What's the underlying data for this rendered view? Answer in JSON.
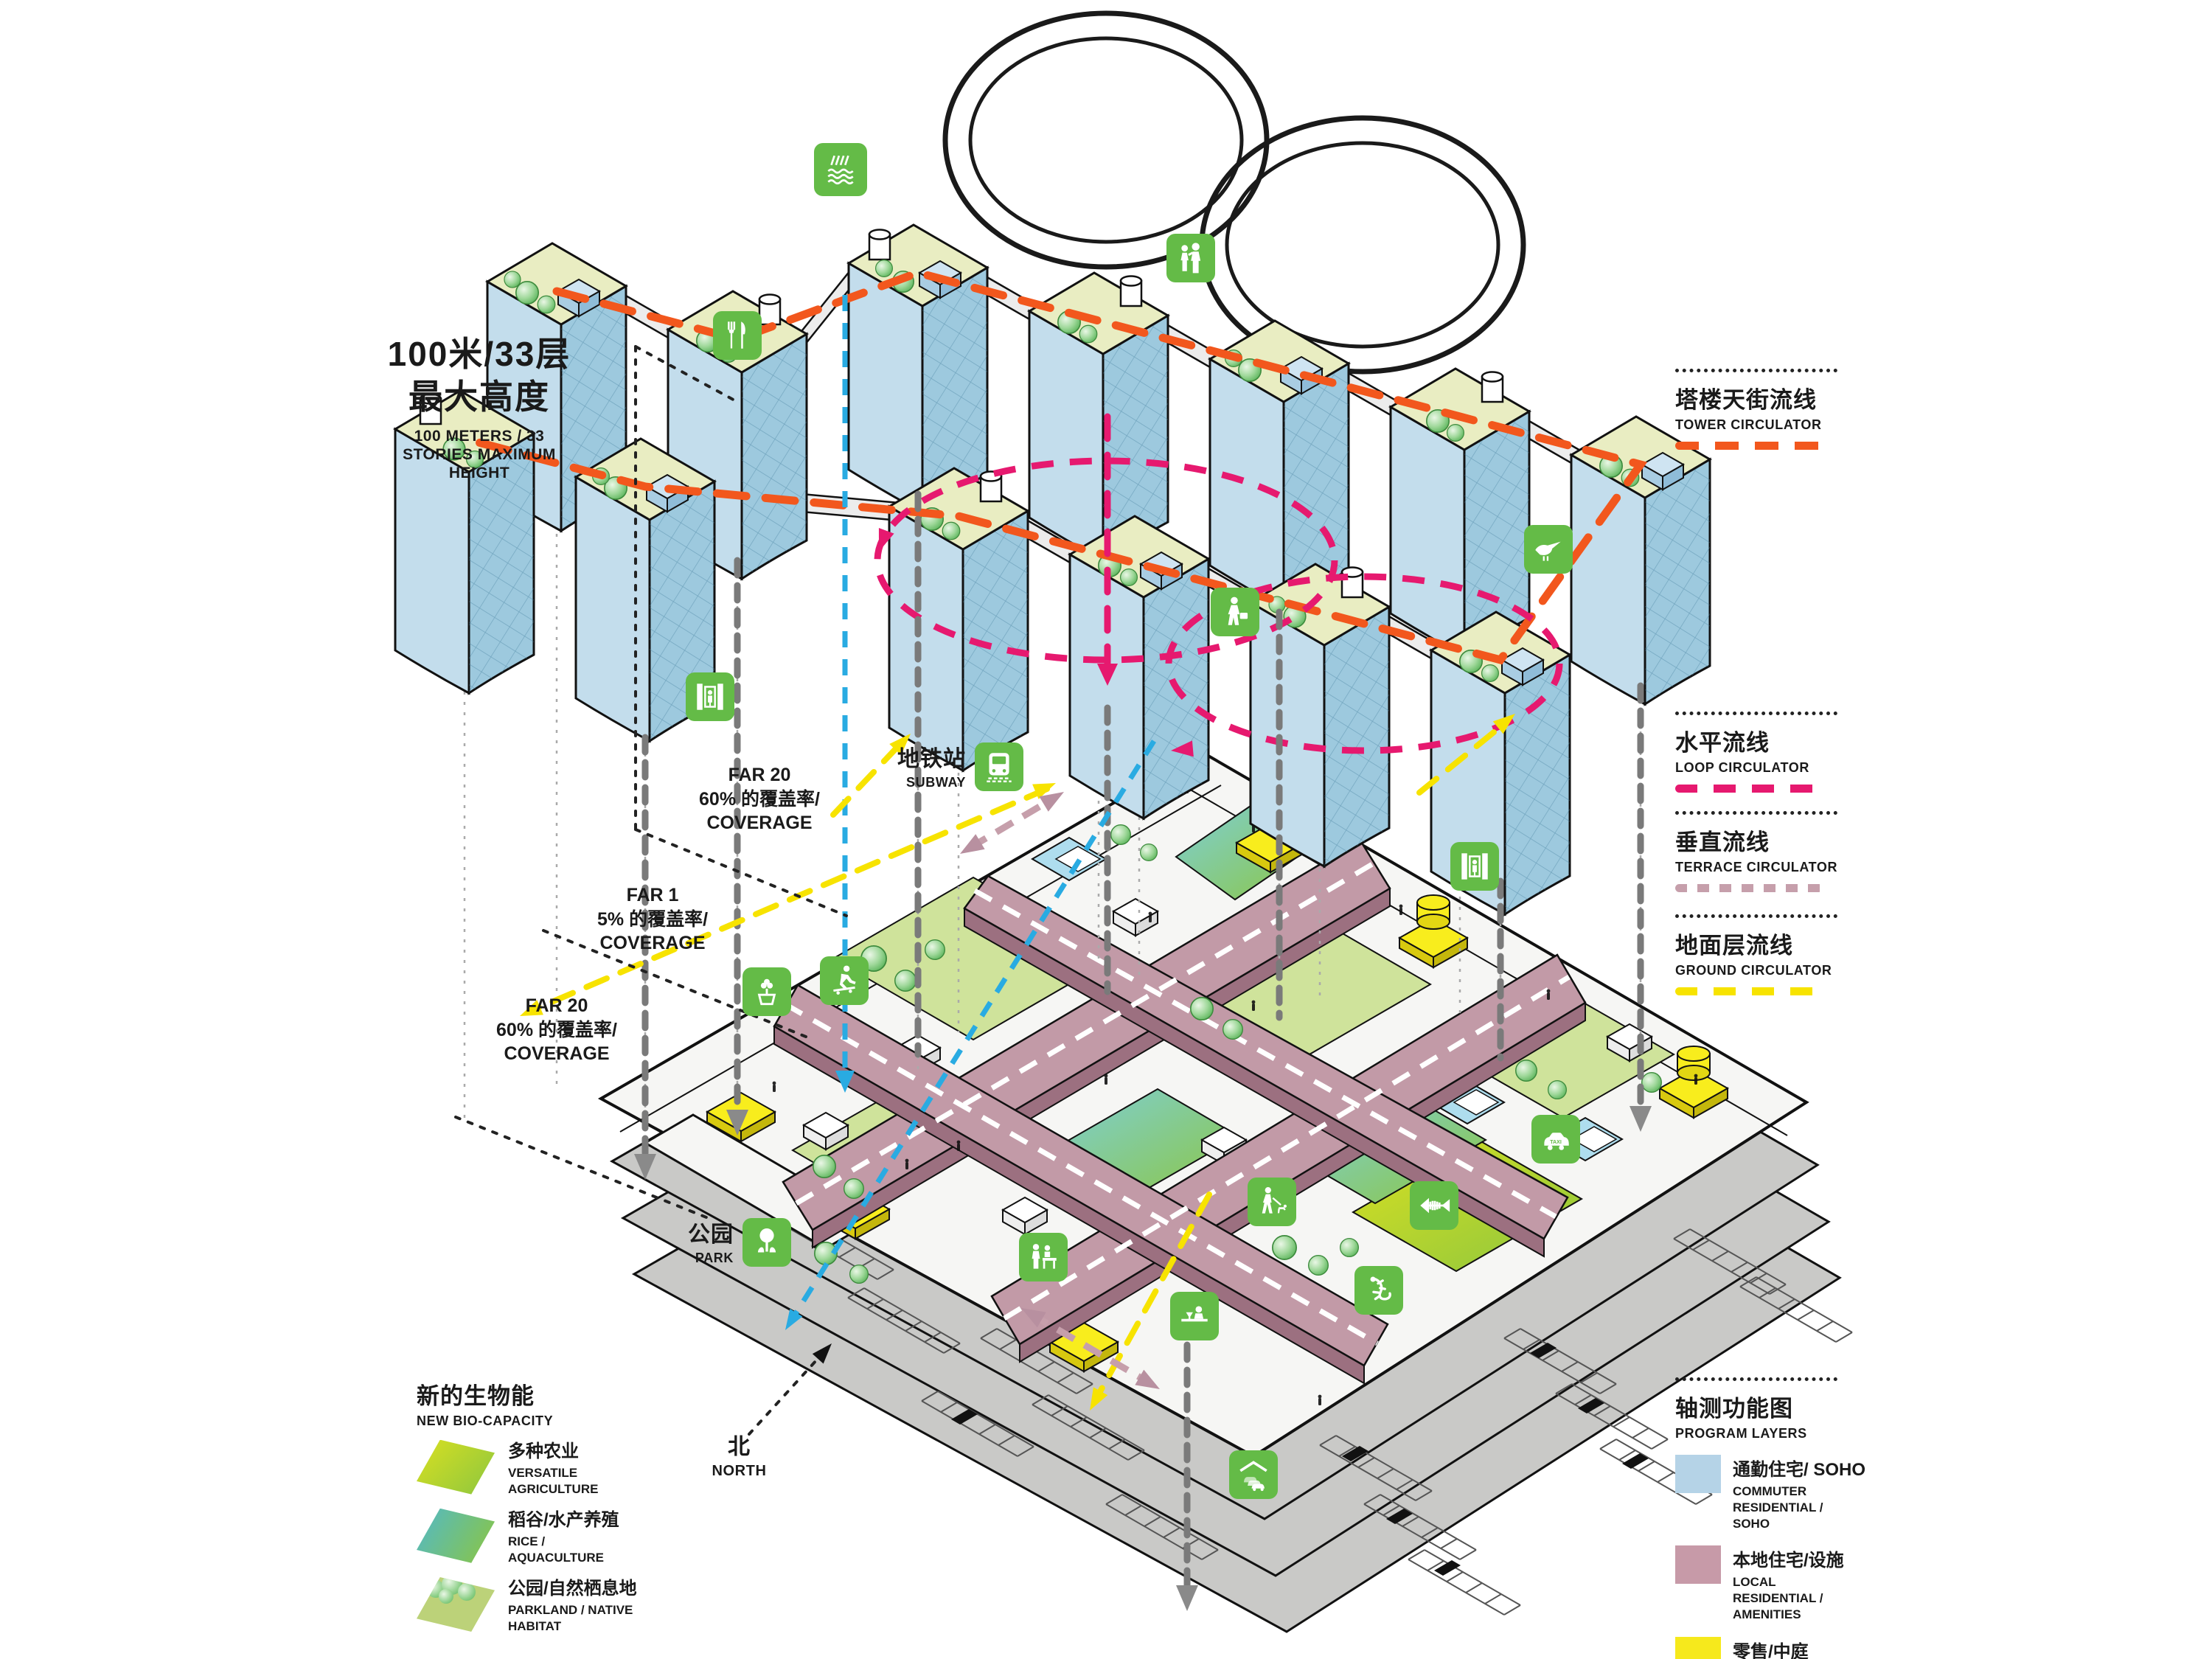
{
  "title_block": {
    "cn1": "100米/33层",
    "cn2": "最大高度",
    "en": "100 METERS / 33 STORIES MAXIMUM HEIGHT"
  },
  "annotations": {
    "far_top": {
      "l1": "FAR 20",
      "l2": "60% 的覆盖率/",
      "l3": "COVERAGE"
    },
    "far_mid": {
      "l1": "FAR 1",
      "l2": "5% 的覆盖率/",
      "l3": "COVERAGE"
    },
    "far_bottom": {
      "l1": "FAR 20",
      "l2": "60% 的覆盖率/",
      "l3": "COVERAGE"
    },
    "subway_cn": "地铁站",
    "subway_en": "SUBWAY",
    "park_cn": "公园",
    "park_en": "PARK",
    "north_cn": "北",
    "north_en": "NORTH"
  },
  "legend_circulators": [
    {
      "cn": "塔楼天街流线",
      "en": "TOWER CIRCULATOR",
      "color": "#f2571d",
      "style": "dashed"
    },
    {
      "cn": "水平流线",
      "en": "LOOP CIRCULATOR",
      "color": "#e6196f",
      "style": "dashed"
    },
    {
      "cn": "垂直流线",
      "en": "TERRACE CIRCULATOR",
      "color": "#c69fab",
      "style": "dotted"
    },
    {
      "cn": "地面层流线",
      "en": "GROUND CIRCULATOR",
      "color": "#f7e300",
      "style": "dashed"
    }
  ],
  "legend_program": {
    "title_cn": "轴测功能图",
    "title_en": "PROGRAM LAYERS",
    "items": [
      {
        "cn": "通勤住宅/ SOHO",
        "en": "COMMUTER RESIDENTIAL / SOHO",
        "color": "#b5d3e7"
      },
      {
        "cn": "本地住宅/设施",
        "en": "LOCAL RESIDENTIAL / AMENITIES",
        "color": "#c79aa8"
      },
      {
        "cn": "零售/中庭",
        "en": "RETAIL / CONCOURSE",
        "color": "#f6e91c"
      }
    ]
  },
  "legend_bio": {
    "title_cn": "新的生物能",
    "title_en": "NEW BIO-CAPACITY",
    "items": [
      {
        "cn": "多种农业",
        "en": "VERSATILE AGRICULTURE"
      },
      {
        "cn": "稻谷/水产养殖",
        "en": "RICE / AQUACULTURE"
      },
      {
        "cn": "公园/自然栖息地",
        "en": "PARKLAND / NATIVE HABITAT"
      }
    ]
  },
  "icons": {
    "taxi_text": "TAXI",
    "names": [
      "irrigation",
      "dining",
      "family",
      "commuter",
      "bird-habitat",
      "elevator",
      "subway-train",
      "tree-planting",
      "skateboarding",
      "park",
      "reception",
      "dog-walking",
      "fish-habitat",
      "lizard-habitat",
      "taxi",
      "bartender",
      "covered-parking"
    ]
  },
  "colors": {
    "icon_green": "#64bb47",
    "tower_blue": "#b5d3e7",
    "amenity_mauve": "#c79aa8",
    "retail_yellow": "#f6e91c",
    "ground_gray": "#c9c9c7"
  }
}
